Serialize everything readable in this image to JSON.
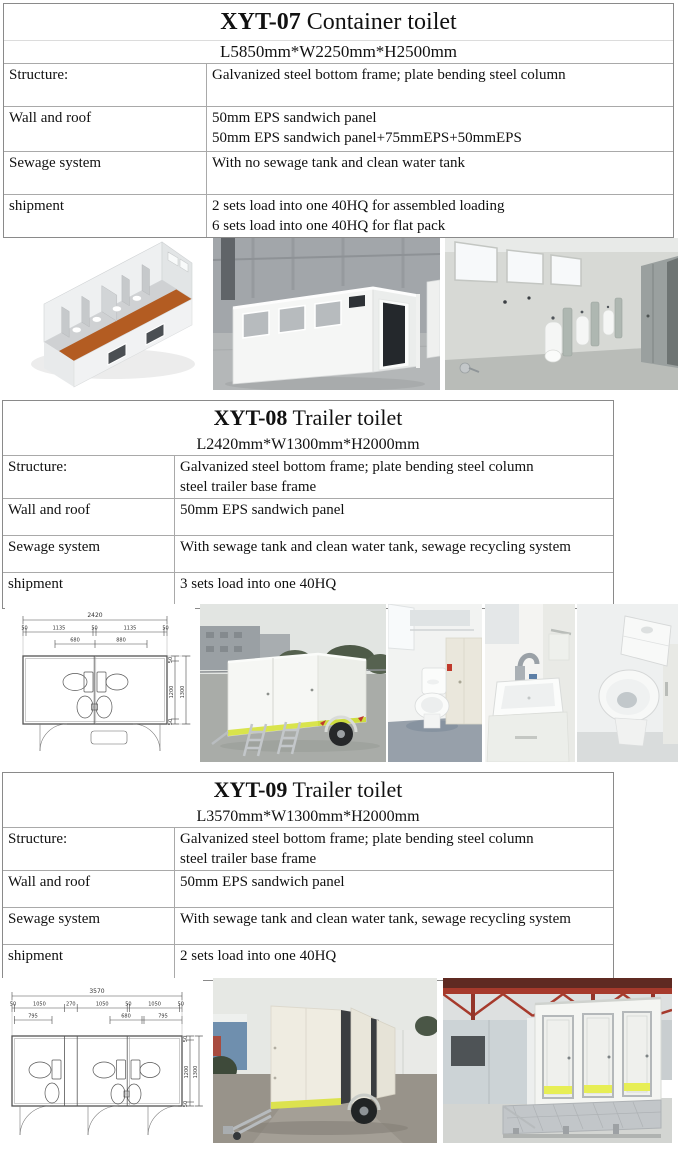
{
  "sections": [
    {
      "model": "XYT-07",
      "type": " Container toilet",
      "size": "L5850mm*W2250mm*H2500mm",
      "rows": [
        {
          "label": "Structure:",
          "lines": [
            "Galvanized steel bottom frame; plate bending steel column"
          ]
        },
        {
          "label": "Wall and roof",
          "lines": [
            "50mm EPS sandwich panel",
            "50mm EPS sandwich panel+75mmEPS+50mmEPS"
          ]
        },
        {
          "label": "Sewage system",
          "lines": [
            "With no sewage tank and clean water tank"
          ]
        },
        {
          "label": "shipment",
          "lines": [
            "2 sets load into one 40HQ for assembled loading",
            "6 sets load into one 40HQ for flat pack"
          ]
        }
      ]
    },
    {
      "model": "XYT-08",
      "type": " Trailer toilet",
      "size": "L2420mm*W1300mm*H2000mm",
      "rows": [
        {
          "label": "Structure:",
          "lines": [
            "Galvanized steel bottom frame; plate bending steel column",
            "steel trailer base frame"
          ]
        },
        {
          "label": "Wall and roof",
          "lines": [
            "50mm EPS sandwich panel"
          ]
        },
        {
          "label": "Sewage system",
          "lines": [
            "With sewage tank and clean water tank, sewage recycling system"
          ]
        },
        {
          "label": "shipment",
          "lines": [
            "3 sets load into one 40HQ"
          ]
        }
      ]
    },
    {
      "model": "XYT-09",
      "type": " Trailer toilet",
      "size": "L3570mm*W1300mm*H2000mm",
      "rows": [
        {
          "label": "Structure:",
          "lines": [
            "Galvanized steel bottom frame; plate bending steel column",
            "steel trailer base frame"
          ]
        },
        {
          "label": "Wall and roof",
          "lines": [
            "50mm EPS sandwich panel"
          ]
        },
        {
          "label": "Sewage system",
          "lines": [
            "With sewage tank and clean water tank, sewage recycling system"
          ]
        },
        {
          "label": "shipment",
          "lines": [
            "2 sets load into one 40HQ"
          ]
        }
      ]
    }
  ],
  "drawings": {
    "xyt08": {
      "overall": "2420",
      "top_segments": [
        "50",
        "1135",
        "50",
        "1135",
        "50"
      ],
      "inner_segments": [
        "680",
        "880"
      ],
      "side": [
        "50",
        "1200",
        "1300",
        "50"
      ]
    },
    "xyt09": {
      "overall": "3570",
      "top_segments": [
        "50",
        "1050",
        "270",
        "1050",
        "50",
        "1050",
        "50"
      ],
      "inner_segments": [
        "795",
        "680",
        "795"
      ],
      "side": [
        "50",
        "1200",
        "1300",
        "50"
      ]
    }
  },
  "photos": {
    "row1": [
      "isometric-cutaway-render",
      "container-toilet-exterior",
      "urinal-room-interior"
    ],
    "row2": [
      "floor-plan-drawing",
      "trailer-toilet-exterior",
      "toilet-cubicle-interior",
      "wash-basin",
      "toilet-closeup"
    ],
    "row3": [
      "floor-plan-drawing",
      "trailer-toilet-doors-open",
      "trailer-toilet-three-doors"
    ]
  },
  "colors": {
    "accent_stripe": "#d9e44c",
    "render_floor_orange": "#b35c22",
    "table_border": "#8a8a8a"
  }
}
